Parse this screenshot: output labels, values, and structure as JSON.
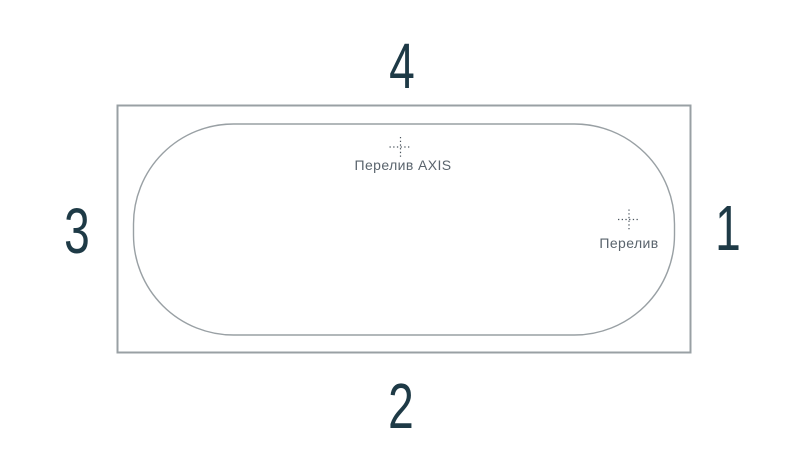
{
  "diagram": {
    "side_numbers": {
      "top": "4",
      "bottom": "2",
      "left": "3",
      "right": "1"
    },
    "markers": [
      {
        "icon": "crosshair-icon",
        "label": "Перелив AXIS"
      },
      {
        "icon": "crosshair-icon",
        "label": "Перелив"
      }
    ],
    "colors": {
      "line": "#99a0a4",
      "number": "#1e3a46",
      "marker_label": "#5a646d",
      "crosshair": "#4b555e",
      "background": "#ffffff"
    }
  }
}
